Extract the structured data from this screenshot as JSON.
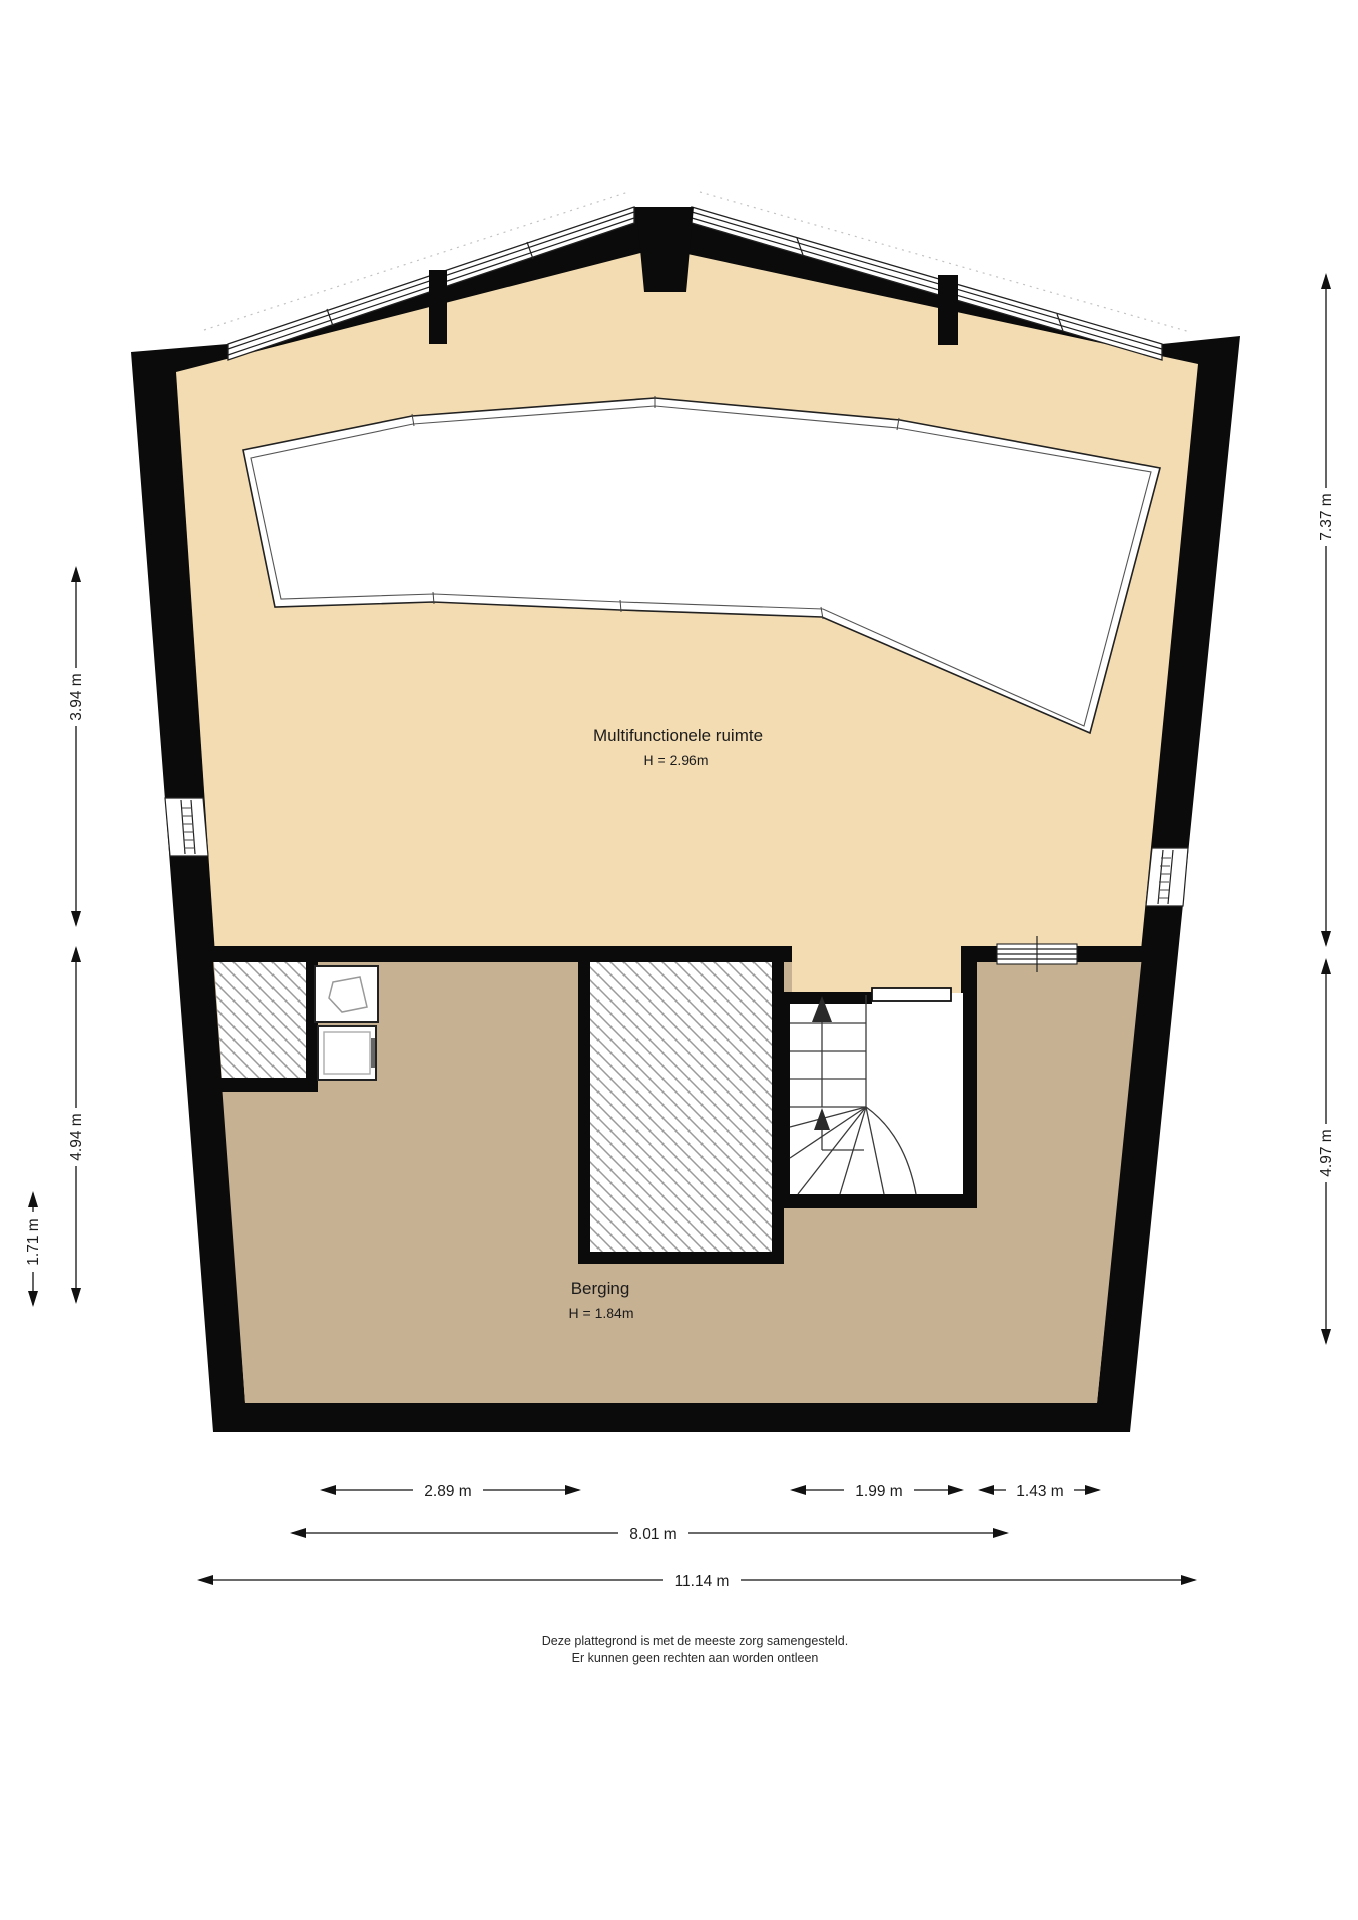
{
  "document": {
    "kind": "attic floor plan",
    "footer_line1": "Deze plattegrond is met de meeste zorg samengesteld.",
    "footer_line2": "Er kunnen geen rechten aan worden ontleen"
  },
  "rooms": {
    "multifunctional": {
      "name": "Multifunctionele ruimte",
      "height": "H = 2.96m"
    },
    "storage": {
      "name": "Berging",
      "height": "H = 1.84m"
    }
  },
  "dimensions": {
    "left_upper": "3.94 m",
    "left_lower": "4.94 m",
    "left_inner": "1.71 m",
    "right_upper": "7.37 m",
    "right_lower": "4.97 m",
    "bottom_left": "2.89 m",
    "bottom_mid": "1.99 m",
    "bottom_right": "1.43 m",
    "bottom_span": "8.01 m",
    "bottom_total": "11.14 m"
  },
  "colors": {
    "upper_floor": "#f3dcb2",
    "lower_floor": "#c7b193",
    "wall": "#0b0b0b",
    "hatch_line": "#9a9a9a"
  }
}
